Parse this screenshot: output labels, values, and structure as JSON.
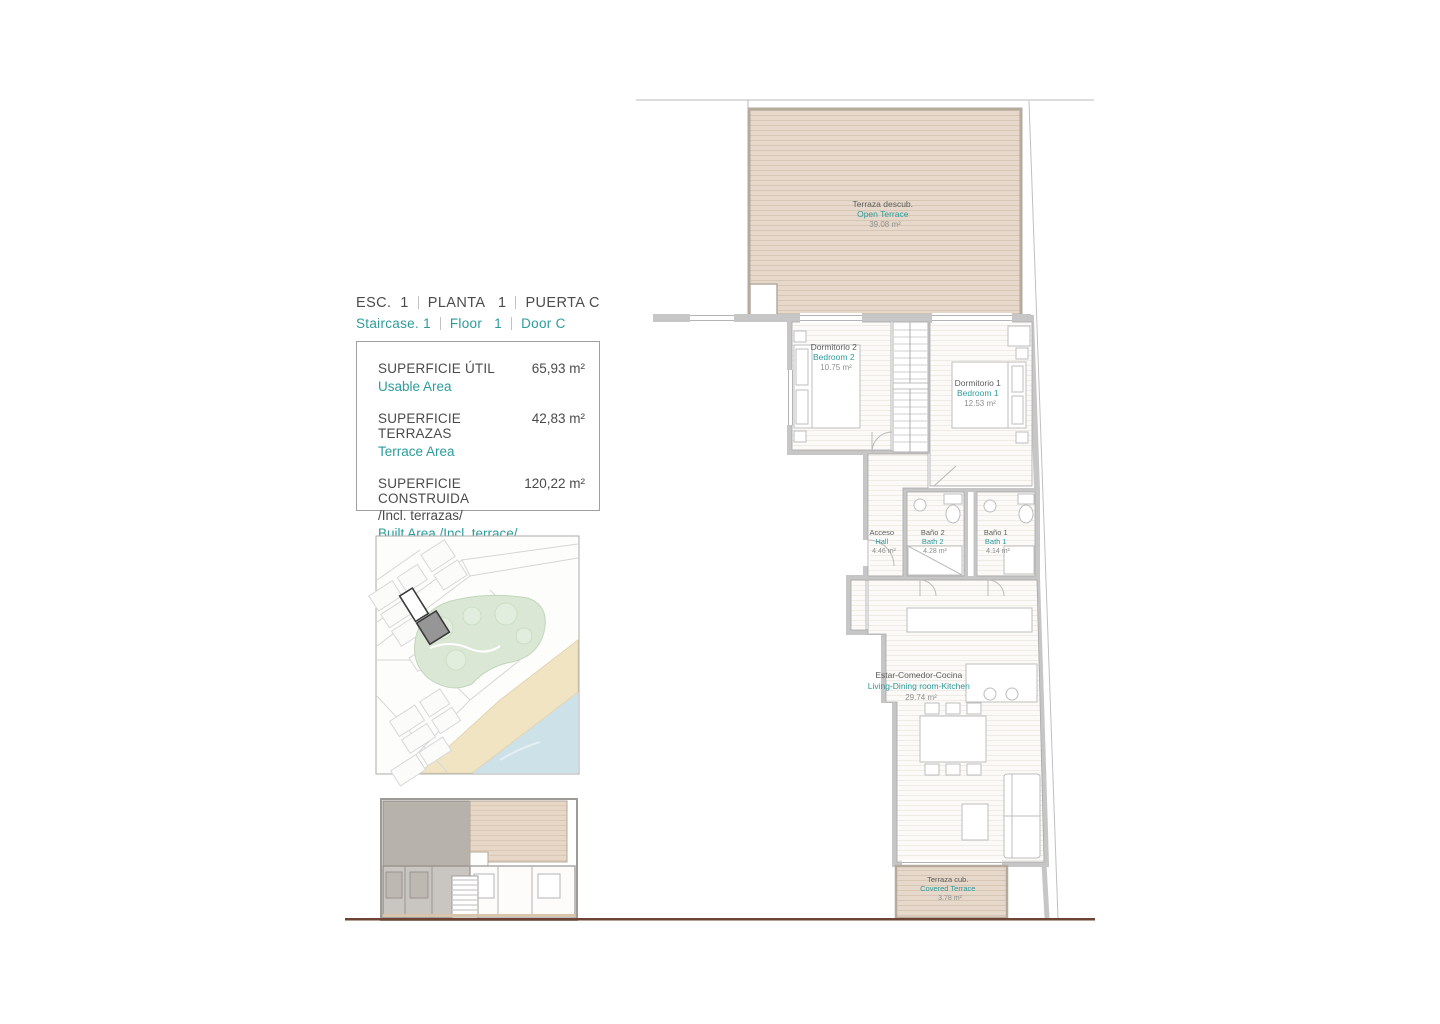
{
  "header": {
    "line1": [
      "ESC.  1",
      "PLANTA   1",
      "PUERTA C"
    ],
    "line2": [
      "Staircase. 1",
      "Floor   1",
      "Door C"
    ]
  },
  "area_box": {
    "rows": [
      {
        "label_es": "SUPERFICIE ÚTIL",
        "value": "65,93 m²",
        "label_en": "Usable Area"
      },
      {
        "label_es": "SUPERFICIE TERRAZAS",
        "value": "42,83 m²",
        "label_en": "Terrace Area"
      },
      {
        "label_es": "SUPERFICIE CONSTRUIDA",
        "value": "120,22 m²",
        "note_es": "/Incl. terrazas/",
        "label_en": "Built Area /Incl. terrace/"
      }
    ]
  },
  "floorplan": {
    "rooms": [
      {
        "name_es": "Terraza descub.",
        "name_en": "Open Terrace",
        "area": "39.08 m²"
      },
      {
        "name_es": "Dormitorio 2",
        "name_en": "Bedroom 2",
        "area": "10.75 m²"
      },
      {
        "name_es": "Dormitorio 1",
        "name_en": "Bedroom 1",
        "area": "12.53 m²"
      },
      {
        "name_es": "Acceso",
        "name_en": "Hall",
        "area": "4.46 m²"
      },
      {
        "name_es": "Baño 2",
        "name_en": "Bath 2",
        "area": "4.28 m²"
      },
      {
        "name_es": "Baño 1",
        "name_en": "Bath 1",
        "area": "4.14 m²"
      },
      {
        "name_es": "Estar-Comedor-Cocina",
        "name_en": "Living-Dining room-Kitchen",
        "area": "29.74 m²"
      },
      {
        "name_es": "Terraza cub.",
        "name_en": "Covered Terrace",
        "area": "3.78 m²"
      }
    ]
  },
  "colors": {
    "teal": "#2d9b9b",
    "text_dark": "#4a4a4a",
    "wall_gray": "#c6c6c6",
    "terrace_fill": "#e6d8ca",
    "park_green": "#d9e7d4",
    "beach_sand": "#f1e4c3",
    "sea_blue": "#cde1e9",
    "base_line": "#6d4433"
  }
}
